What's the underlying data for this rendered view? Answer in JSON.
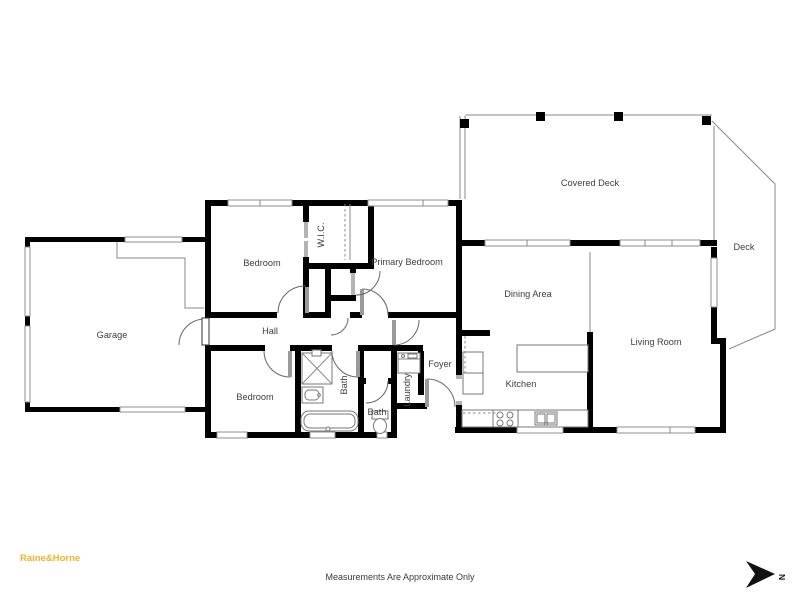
{
  "page": {
    "background": "#ffffff"
  },
  "branding": {
    "logo_text": "Raine&Horne",
    "logo_color": "#F0B32A"
  },
  "footer": {
    "disclaimer": "Measurements Are Approximate Only"
  },
  "compass": {
    "label": "N"
  },
  "plan": {
    "wall_color": "#000000",
    "line_color": "#8a8a8a",
    "label_color": "#3d3d3d",
    "rooms": [
      {
        "name": "garage",
        "label": "Garage"
      },
      {
        "name": "bedroom-upper",
        "label": "Bedroom"
      },
      {
        "name": "wic",
        "label": "W.I.C."
      },
      {
        "name": "primary-bedroom",
        "label": "Primary Bedroom"
      },
      {
        "name": "covered-deck",
        "label": "Covered Deck"
      },
      {
        "name": "deck",
        "label": "Deck"
      },
      {
        "name": "dining-area",
        "label": "Dining Area"
      },
      {
        "name": "living-room",
        "label": "Living Room"
      },
      {
        "name": "hall",
        "label": "Hall"
      },
      {
        "name": "bedroom-lower",
        "label": "Bedroom"
      },
      {
        "name": "bath-main",
        "label": "Bath"
      },
      {
        "name": "bath-second",
        "label": "Bath"
      },
      {
        "name": "laundry",
        "label": "Laundry"
      },
      {
        "name": "foyer",
        "label": "Foyer"
      },
      {
        "name": "kitchen",
        "label": "Kitchen"
      }
    ]
  }
}
